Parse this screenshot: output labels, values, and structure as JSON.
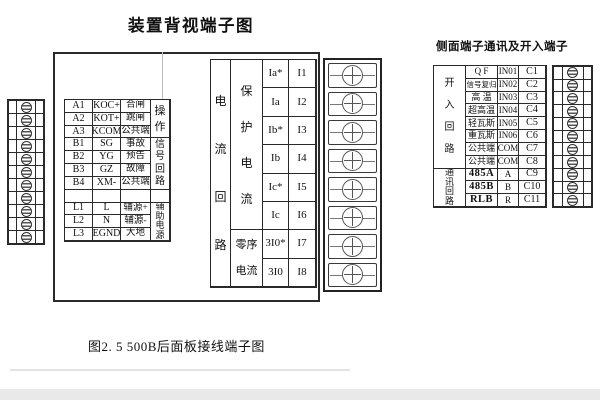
{
  "page": {
    "title": "装置背视端子图",
    "side_title": "侧面端子通讯及开入端子",
    "caption": "图2. 5   500B后面板接线端子图"
  },
  "left_table": {
    "groups": {
      "op": "操作",
      "sig": "信号回路",
      "aux": "辅助电源",
      "blank": ""
    },
    "rows": [
      {
        "no": "A1",
        "code": "KOC+",
        "desc": "合闸"
      },
      {
        "no": "A2",
        "code": "KOT+",
        "desc": "跳闸"
      },
      {
        "no": "A3",
        "code": "KCOM",
        "desc": "公共端"
      },
      {
        "no": "B1",
        "code": "SG",
        "desc": "事故"
      },
      {
        "no": "B2",
        "code": "YG",
        "desc": "预告"
      },
      {
        "no": "B3",
        "code": "GZ",
        "desc": "故障"
      },
      {
        "no": "B4",
        "code": "XM-",
        "desc": "公共端"
      },
      {
        "no": "",
        "code": "",
        "desc": ""
      },
      {
        "no": "L1",
        "code": "L",
        "desc": "辅源+"
      },
      {
        "no": "L2",
        "code": "N",
        "desc": "辅源-"
      },
      {
        "no": "L3",
        "code": "EGND",
        "desc": "大地"
      }
    ]
  },
  "current_table": {
    "circuit_label": "电流回路",
    "groups": {
      "protection": "保护电流",
      "zero_seq": "零序电流"
    },
    "rows": [
      {
        "signal": "Ia*",
        "terminal": "I1"
      },
      {
        "signal": "Ia",
        "terminal": "I2"
      },
      {
        "signal": "Ib*",
        "terminal": "I3"
      },
      {
        "signal": "Ib",
        "terminal": "I4"
      },
      {
        "signal": "Ic*",
        "terminal": "I5"
      },
      {
        "signal": "Ic",
        "terminal": "I6"
      },
      {
        "signal": "3I0*",
        "terminal": "I7"
      },
      {
        "signal": "3I0",
        "terminal": "I8"
      }
    ]
  },
  "side_table": {
    "groups": {
      "input": "开入回路",
      "comm": "通讯回路"
    },
    "rows": [
      {
        "name": "Q F",
        "code": "IN01",
        "terminal": "C1"
      },
      {
        "name": "信号复归",
        "code": "IN02",
        "terminal": "C2"
      },
      {
        "name": "高 温",
        "code": "IN03",
        "terminal": "C3"
      },
      {
        "name": "超高温",
        "code": "IN04",
        "terminal": "C4"
      },
      {
        "name": "轻瓦斯",
        "code": "IN05",
        "terminal": "C5"
      },
      {
        "name": "重瓦斯",
        "code": "IN06",
        "terminal": "C6"
      },
      {
        "name": "公共端",
        "code": "COM",
        "terminal": "C7"
      },
      {
        "name": "公共端",
        "code": "COM",
        "terminal": "C8"
      },
      {
        "name": "485A",
        "code": "A",
        "terminal": "C9"
      },
      {
        "name": "485B",
        "code": "B",
        "terminal": "C10"
      },
      {
        "name": "RLB",
        "code": "R",
        "terminal": "C11"
      }
    ]
  },
  "terminal_strips": {
    "left": {
      "count": 11,
      "style": "slot"
    },
    "current": {
      "count": 8,
      "style": "cross"
    },
    "side": {
      "count": 11,
      "style": "slot"
    }
  },
  "colors": {
    "line": "#2a2a2a",
    "bottom_band": "#e9e9e9"
  }
}
